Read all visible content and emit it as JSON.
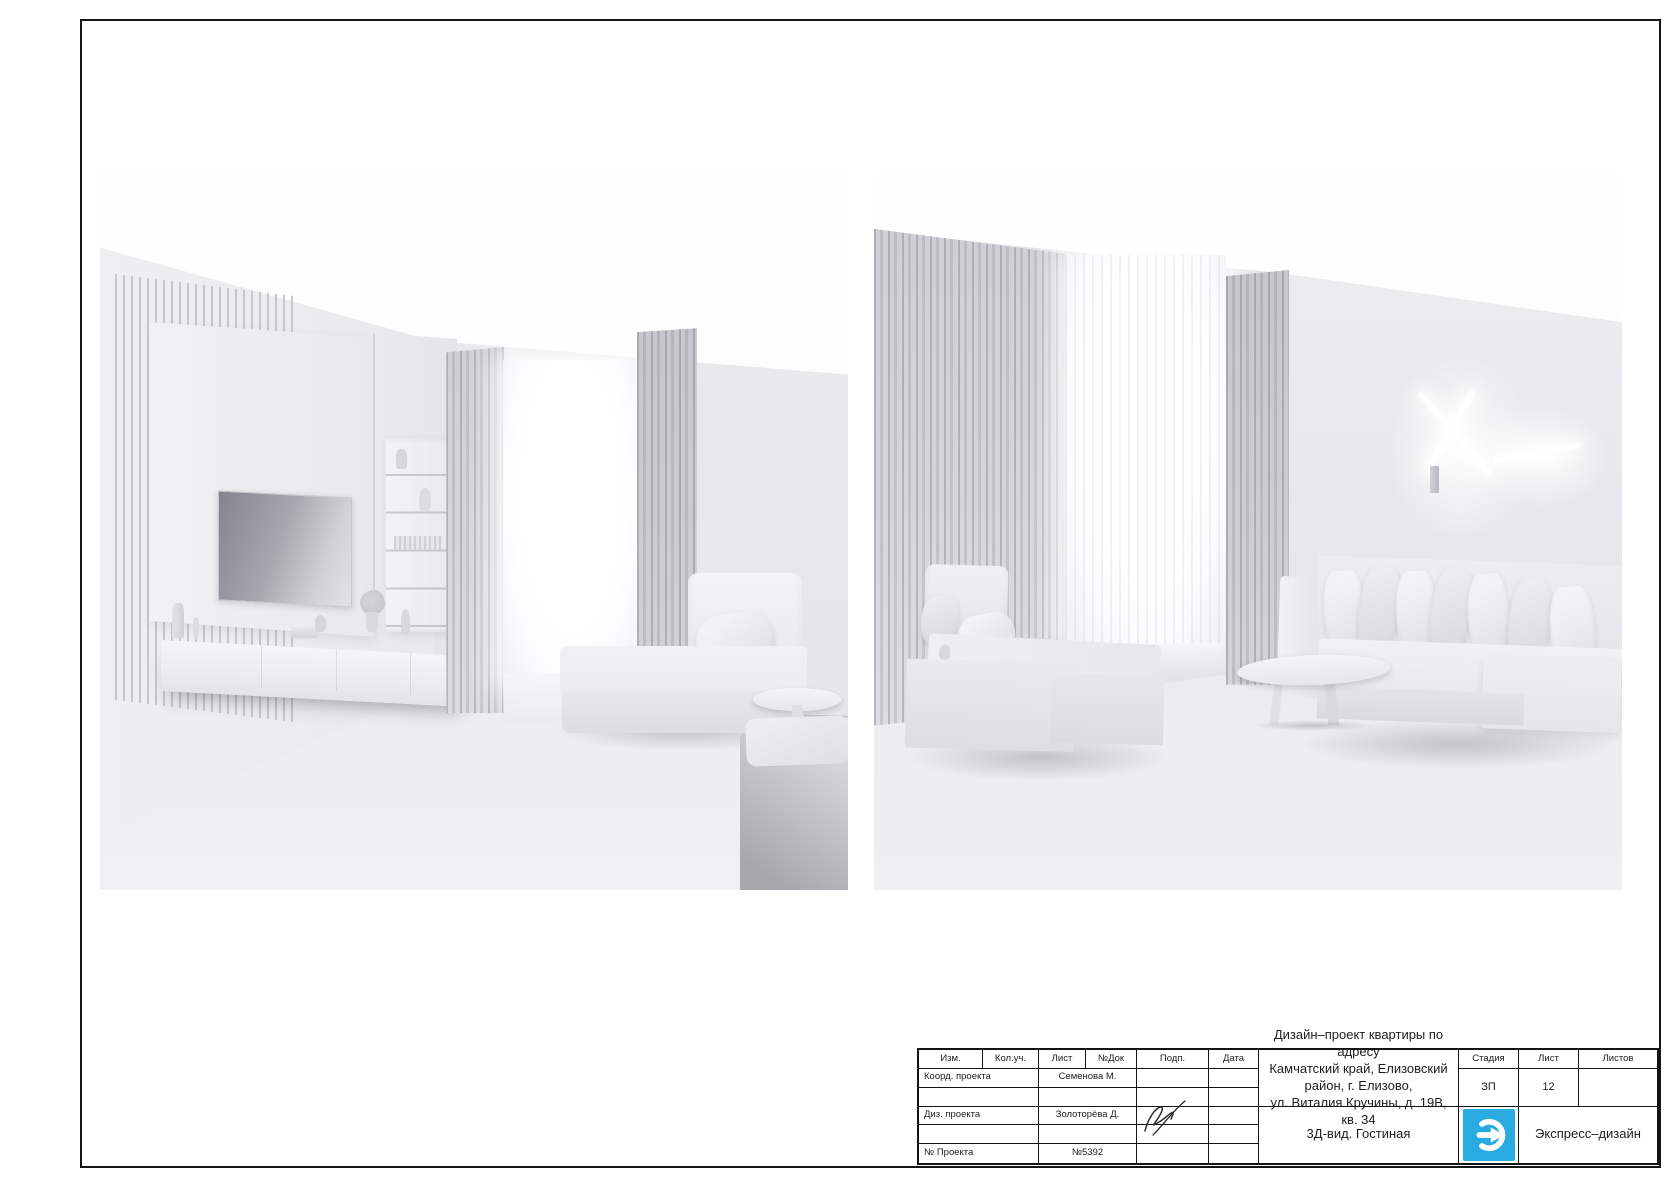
{
  "sheet": {
    "renders": {
      "left": {
        "description": "3D-визуализация гостиной: ТВ-зона с реечной стеновой панелью, телевизором, стеллажом и подвесной тумбой с декором, окно с тюлем и шторами, модульное кресло с подушкой, приставной столик и пуф"
      },
      "right": {
        "description": "3D-визуализация гостиной: шторы и тюль на окне, большой модульный диван с подушками вдоль стены, кресло-шезлонг с подушками, овальный журнальный столик, настенный светильник из перекрещенных световых линий"
      }
    },
    "title_block": {
      "revision_headers": [
        "Изм.",
        "Кол.уч.",
        "Лист",
        "№Док",
        "Подп.",
        "Дата"
      ],
      "rows": [
        {
          "label": "Коорд. проекта",
          "value": "Семенова М."
        },
        {
          "label": "Диз. проекта",
          "value": "Золоторёва Д."
        },
        {
          "label": "№ Проекта",
          "value": "№5392"
        }
      ],
      "project_title": {
        "line1": "Дизайн–проект квартиры по адресу",
        "line2": "Камчатский край, Елизовский район, г. Елизово,",
        "line3": "ул. Виталия Кручины, д. 19В, кв. 34"
      },
      "view_title": "3Д-вид. Гостиная",
      "stage": {
        "label": "Стадия",
        "value": "ЗП"
      },
      "sheet_no": {
        "label": "Лист",
        "value": "12"
      },
      "sheets_total": {
        "label": "Листов",
        "value": ""
      },
      "company_name": "Экспресс–дизайн",
      "logo_color": "#29abe2"
    }
  }
}
